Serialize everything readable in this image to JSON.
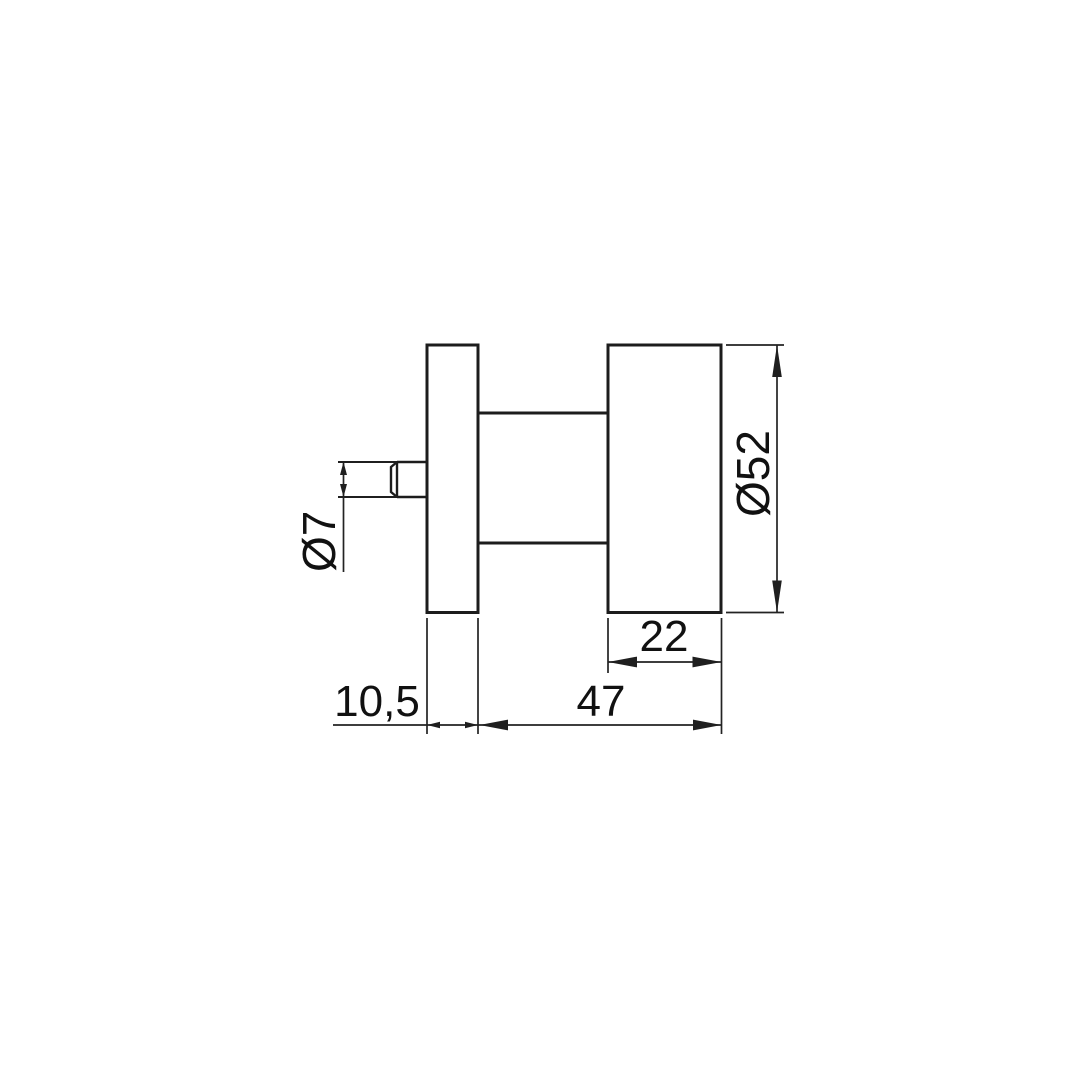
{
  "drawing": {
    "kind": "technical-dimension-drawing",
    "subject": "door knob with rose, side elevation",
    "colors": {
      "background": "#ffffff",
      "line": "#1c1c1c",
      "text": "#111111"
    },
    "dimensions": {
      "spindle_diameter": {
        "label": "Ø7",
        "value": 7
      },
      "knob_diameter": {
        "label": "Ø52",
        "value": 52
      },
      "knob_depth": {
        "label": "22",
        "value": 22
      },
      "projection": {
        "label": "47",
        "value": 47
      },
      "rose_thickness": {
        "label": "10,5",
        "value": 10.5
      }
    }
  }
}
